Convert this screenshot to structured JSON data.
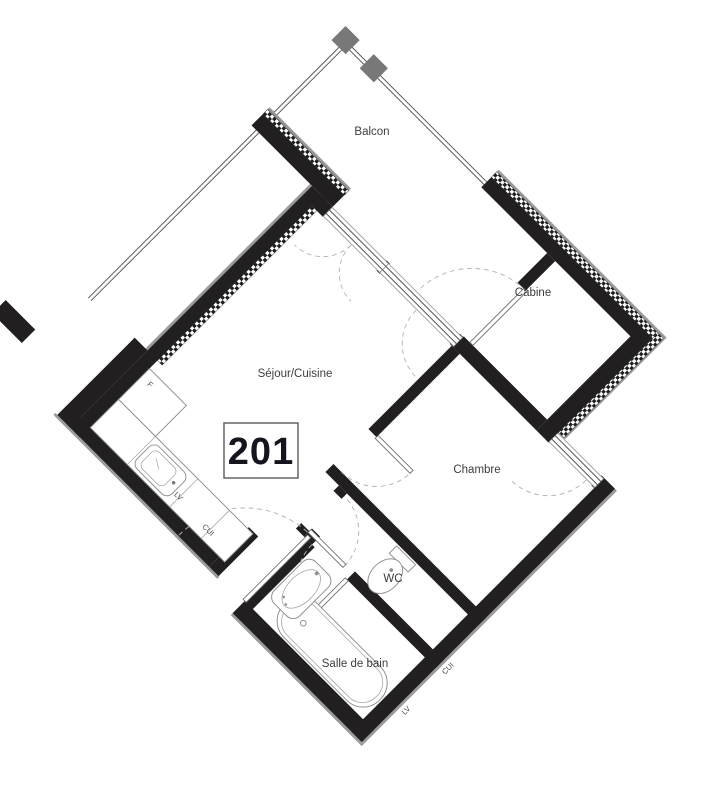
{
  "unit": {
    "number": "201"
  },
  "rooms": {
    "balcon": "Balcon",
    "cabine": "Cabine",
    "sejour_cuisine": "Séjour/Cuisine",
    "chambre": "Chambre",
    "wc": "WC",
    "salle_de_bain": "Salle de bain"
  },
  "kitchen": {
    "fridge": "F",
    "dishwasher": "LV",
    "cooker": "CUI"
  },
  "neighbor": {
    "dishwasher": "LV",
    "cooker": "CUI"
  },
  "colors": {
    "wall": "#221f20",
    "insulation_hatch": "#1e1e1e",
    "gray_band": "#9b9b9b",
    "balcony_post": "#787878",
    "door_arc": "#b5b5b5",
    "room_label": "#3d3d3d",
    "unit_text": "#15151f"
  }
}
